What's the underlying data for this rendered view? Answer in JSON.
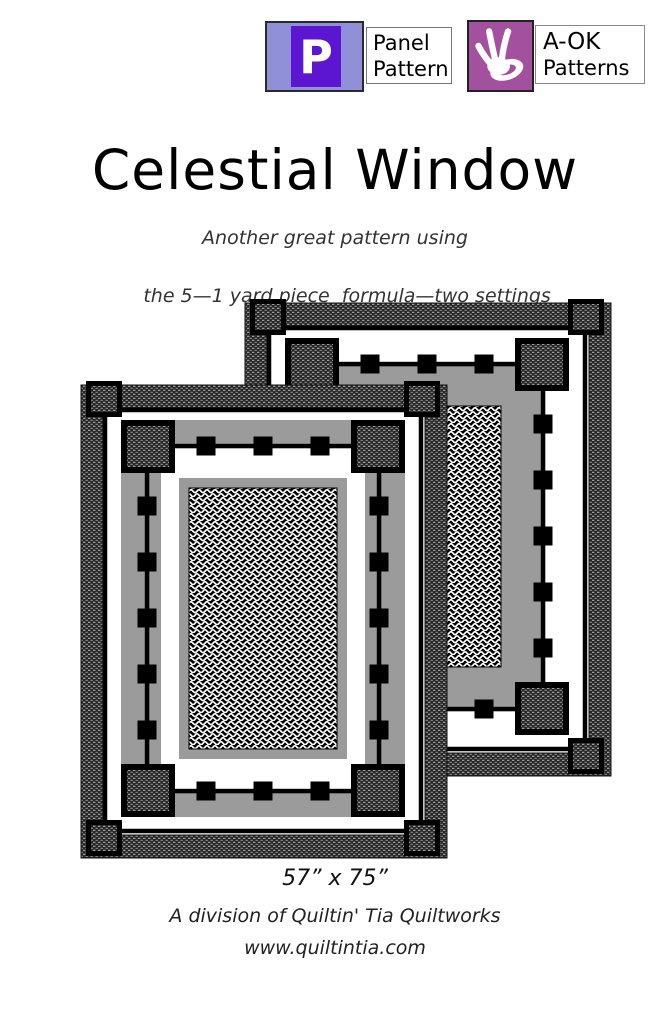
{
  "header": {
    "panel_pattern_badge": {
      "initial": "P",
      "label_line1": "Panel",
      "label_line2": "Pattern",
      "square_color": "#9090d8",
      "inner_color": "#5c16d2"
    },
    "aok_badge": {
      "label_line1": "A-OK",
      "label_line2": "Patterns",
      "square_color": "#a3519f",
      "hand_icon": "ok-hand-icon"
    }
  },
  "title": "Celestial Window",
  "subtitle": {
    "line1": "Another great pattern using",
    "line2": "the 5—1 yard piece  formula—two settings"
  },
  "quilt": {
    "size_label": "57” x 75”",
    "colors": {
      "gray": "#9b9b9b",
      "black": "#000000",
      "white": "#ffffff"
    }
  },
  "footer": {
    "division": "A division of Quiltin' Tia Quiltworks",
    "website": "www.quiltintia.com"
  }
}
